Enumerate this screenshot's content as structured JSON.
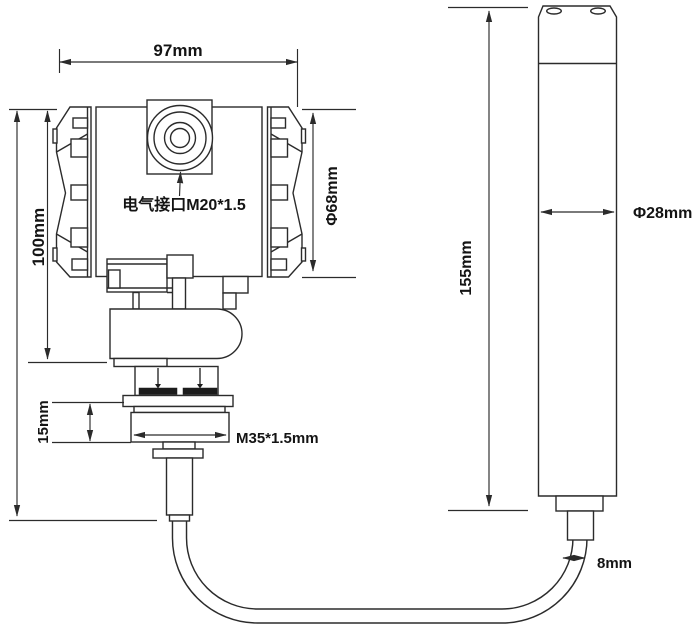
{
  "drawing": {
    "transmitter": {
      "width_label": "97mm",
      "height_label": "100mm",
      "housing_diameter_label": "Φ68mm",
      "electrical_port_label": "电气接口M20*1.5",
      "thread_section_height_label": "15mm",
      "thread_spec_label": "M35*1.5mm"
    },
    "probe": {
      "length_label": "155mm",
      "diameter_label": "Φ28mm"
    },
    "cable": {
      "diameter_label": "8mm"
    },
    "colors": {
      "line": "#2b2b2b",
      "text": "#141414",
      "background": "#ffffff"
    }
  }
}
